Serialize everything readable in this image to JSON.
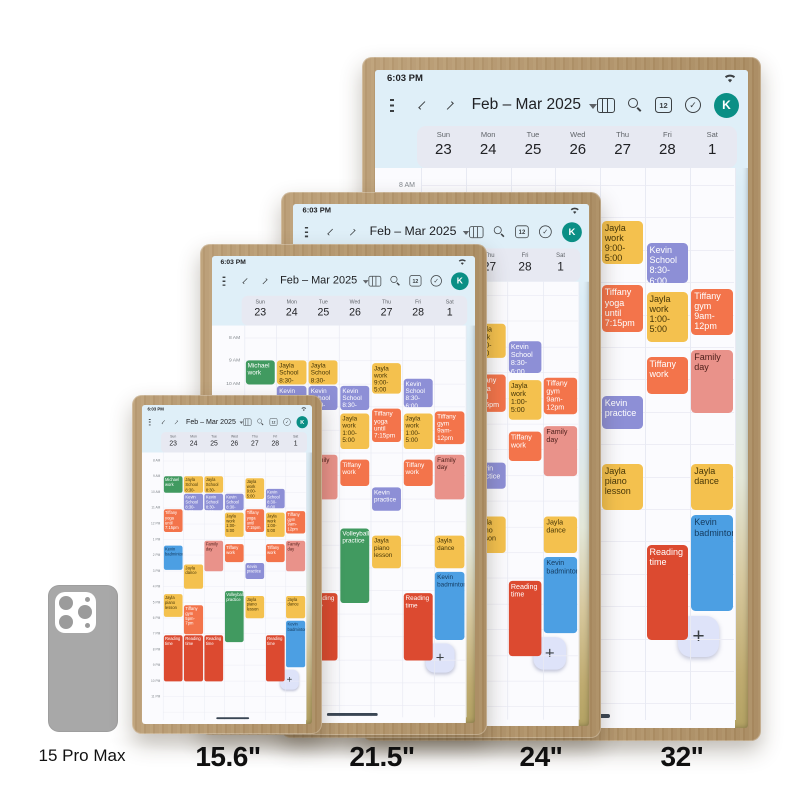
{
  "page": {
    "size_labels": [
      "15.6\"",
      "21.5\"",
      "24\"",
      "32\""
    ],
    "phone_label": "15 Pro Max"
  },
  "colors": {
    "frame_wood": "#b5966b",
    "header_bg": "#dfeff8",
    "day_panel_bg": "#e7e9f2",
    "avatar_teal": "#0a8f85",
    "event_yellow": "#f4c14e",
    "event_purple": "#8d8fd6",
    "event_orange": "#f3744b",
    "event_salmon": "#e9928a",
    "event_green": "#419a60",
    "event_blue": "#4c9fe3",
    "event_red": "#dc4a30"
  },
  "calendar": {
    "status_time": "6:03 PM",
    "nav_title": "Feb – Mar 2025",
    "calendar_badge": "12",
    "avatar_initial": "K",
    "fab_label": "+",
    "days": [
      {
        "weekday": "Sun",
        "date": "23"
      },
      {
        "weekday": "Mon",
        "date": "24"
      },
      {
        "weekday": "Tue",
        "date": "25"
      },
      {
        "weekday": "Wed",
        "date": "26"
      },
      {
        "weekday": "Thu",
        "date": "27"
      },
      {
        "weekday": "Fri",
        "date": "28"
      },
      {
        "weekday": "Sat",
        "date": "1"
      }
    ],
    "hours": [
      "8 AM",
      "9 AM",
      "10 AM",
      "11 AM",
      "12 PM",
      "1 PM",
      "2 PM",
      "3 PM",
      "4 PM",
      "5 PM",
      "6 PM",
      "7 PM",
      "8 PM",
      "9 PM",
      "10 PM",
      "11 PM"
    ],
    "events": [
      {
        "day": 0,
        "start": 1.0,
        "end": 2.1,
        "title": "Michael work",
        "color": "green"
      },
      {
        "day": 0,
        "start": 3.1,
        "end": 4.6,
        "title": "Tiffany yoga until 7:15pm",
        "color": "orange"
      },
      {
        "day": 0,
        "start": 5.4,
        "end": 7.0,
        "title": "Kevin badminton",
        "color": "blue"
      },
      {
        "day": 0,
        "start": 8.5,
        "end": 10.0,
        "title": "Jayla piano lesson",
        "color": "yellow"
      },
      {
        "day": 0,
        "start": 11.1,
        "end": 14.1,
        "title": "Reading time",
        "color": "red"
      },
      {
        "day": 1,
        "start": 1.0,
        "end": 2.1,
        "title": "Jayla School 8:30-6:00",
        "color": "yellow"
      },
      {
        "day": 1,
        "start": 2.1,
        "end": 3.2,
        "title": "Kevin School 8:30-6:00",
        "color": "purple"
      },
      {
        "day": 1,
        "start": 6.6,
        "end": 8.2,
        "title": "Jayla dance",
        "color": "yellow"
      },
      {
        "day": 1,
        "start": 9.2,
        "end": 11.1,
        "title": "Tiffany gym 5pm-7pm",
        "color": "orange"
      },
      {
        "day": 1,
        "start": 11.1,
        "end": 14.1,
        "title": "Reading time",
        "color": "red"
      },
      {
        "day": 2,
        "start": 1.0,
        "end": 2.1,
        "title": "Jayla School 8:30-6:00",
        "color": "yellow"
      },
      {
        "day": 2,
        "start": 2.1,
        "end": 3.2,
        "title": "Kevin School 8:30-6:00",
        "color": "purple"
      },
      {
        "day": 2,
        "start": 5.1,
        "end": 7.1,
        "title": "Family day",
        "color": "salmon"
      },
      {
        "day": 2,
        "start": 11.1,
        "end": 14.1,
        "title": "Reading time",
        "color": "red"
      },
      {
        "day": 3,
        "start": 2.1,
        "end": 3.2,
        "title": "Kevin School 8:30-6:00",
        "color": "purple"
      },
      {
        "day": 3,
        "start": 3.3,
        "end": 4.9,
        "title": "Jayla work 1:00-5:00",
        "color": "yellow"
      },
      {
        "day": 3,
        "start": 5.3,
        "end": 6.5,
        "title": "Tiffany work",
        "color": "orange"
      },
      {
        "day": 3,
        "start": 8.3,
        "end": 11.6,
        "title": "Volleyball practice",
        "color": "green"
      },
      {
        "day": 4,
        "start": 1.1,
        "end": 2.5,
        "title": "Jayla work 9:00-5:00",
        "color": "yellow"
      },
      {
        "day": 4,
        "start": 3.1,
        "end": 4.6,
        "title": "Tiffany yoga until 7:15pm",
        "color": "orange"
      },
      {
        "day": 4,
        "start": 6.5,
        "end": 7.6,
        "title": "Kevin practice",
        "color": "purple"
      },
      {
        "day": 4,
        "start": 8.6,
        "end": 10.1,
        "title": "Jayla piano lesson",
        "color": "yellow"
      },
      {
        "day": 5,
        "start": 1.8,
        "end": 3.1,
        "title": "Kevin School 8:30-6:00",
        "color": "purple"
      },
      {
        "day": 5,
        "start": 3.3,
        "end": 4.9,
        "title": "Jayla work 1:00-5:00",
        "color": "yellow"
      },
      {
        "day": 5,
        "start": 5.3,
        "end": 6.5,
        "title": "Tiffany work",
        "color": "orange"
      },
      {
        "day": 5,
        "start": 11.1,
        "end": 14.1,
        "title": "Reading time",
        "color": "red"
      },
      {
        "day": 6,
        "start": 3.2,
        "end": 4.7,
        "title": "Tiffany gym 9am-12pm",
        "color": "orange"
      },
      {
        "day": 6,
        "start": 5.1,
        "end": 7.1,
        "title": "Family day",
        "color": "salmon"
      },
      {
        "day": 6,
        "start": 8.6,
        "end": 10.1,
        "title": "Jayla dance",
        "color": "yellow"
      },
      {
        "day": 6,
        "start": 10.2,
        "end": 13.2,
        "title": "Kevin badminton",
        "color": "blue"
      }
    ]
  }
}
